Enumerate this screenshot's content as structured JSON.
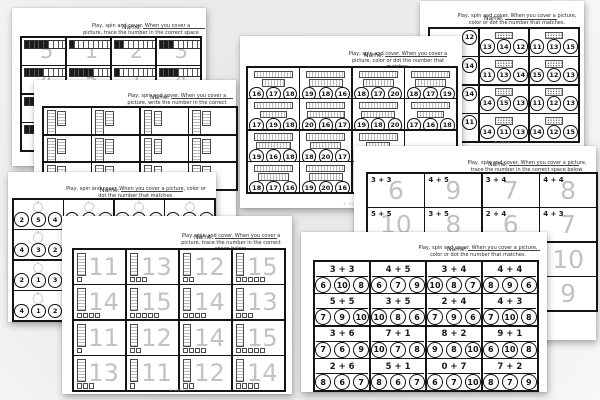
{
  "common": {
    "name_label": "Name:",
    "footer_credit": "© 2018"
  },
  "pages": {
    "trace_1_5": {
      "title": "Spin and cover — trace numbers 1 to 5 with counting frames",
      "instruction": "Play, spin and cover. When you cover a picture, trace the number in the correct space below.",
      "cell_type": "frame_trace",
      "rows": [
        [
          {
            "frame": 5,
            "num": "5"
          },
          {
            "frame": 1,
            "num": "1"
          },
          {
            "frame": 2,
            "num": "2"
          },
          {
            "frame": 3,
            "num": "3"
          }
        ],
        [
          {
            "frame": 4,
            "num": "4"
          },
          {
            "frame": 5,
            "num": "5"
          },
          {
            "frame": 1,
            "num": "1"
          },
          {
            "frame": 4,
            "num": "4"
          }
        ],
        [
          {
            "frame": 2
          },
          {},
          {},
          {}
        ],
        [
          {
            "frame": 5
          },
          {},
          {},
          {}
        ]
      ]
    },
    "write_teens": {
      "title": "Spin and cover — write the number shown by base-ten rods",
      "instruction": "Play, spin and cover. When you cover a picture, write the number in the correct space below.",
      "cell_type": "rods_write",
      "rows": [
        [
          {
            "rods": true
          },
          {
            "rods": true
          },
          {
            "rods": true
          },
          {
            "rods": true
          }
        ],
        [
          {
            "rods": true
          },
          {
            "rods": true
          },
          {
            "rods": true
          },
          {
            "rods": true
          }
        ],
        [
          {
            "rods": true
          },
          {
            "rods": true
          },
          {
            "rods": true
          },
          {
            "rods": true
          }
        ]
      ]
    },
    "color_16_20": {
      "title": "Spin and cover — color or dot the matching number 16 to 20",
      "instruction": "Play, spin and cover. When you cover a picture, color or dot the number that matches.",
      "cell_type": "rod_circles",
      "rows": [
        [
          {
            "circles": [
              16,
              17,
              18
            ]
          },
          {
            "circles": [
              19,
              18,
              16
            ]
          },
          {
            "circles": [
              18,
              17,
              20
            ]
          },
          {
            "circles": [
              18,
              17,
              19
            ]
          }
        ],
        [
          {
            "circles": [
              17,
              19,
              18
            ]
          },
          {
            "circles": [
              20,
              16,
              17
            ]
          },
          {
            "circles": [
              19,
              18,
              20
            ]
          },
          {
            "circles": [
              17,
              16,
              18
            ]
          }
        ],
        [
          {
            "circles": [
              19,
              16,
              18
            ]
          },
          {
            "circles": [
              18,
              20,
              17
            ]
          },
          {
            "circles": [
              16
            ]
          },
          {}
        ],
        [
          {
            "circles": [
              18,
              17,
              16
            ]
          },
          {
            "circles": [
              19,
              20,
              16
            ]
          },
          {
            "circles": [
              18
            ]
          },
          {}
        ]
      ]
    },
    "color_11_15": {
      "title": "Spin and cover — color or dot the matching number 11 to 15",
      "instruction": "Play, spin and cover. When you cover a picture, color or dot the number that matches.",
      "cell_type": "frame_circles",
      "rows": [
        [
          {
            "circles": [
              12
            ],
            "partial": true
          },
          {
            "circles": [
              13,
              14,
              12
            ]
          },
          {
            "circles": [
              11,
              13,
              15
            ]
          }
        ],
        [
          {
            "circles": [
              14
            ],
            "partial": true
          },
          {
            "circles": [
              11,
              13,
              14
            ]
          },
          {
            "circles": [
              15,
              12,
              13
            ]
          }
        ],
        [
          {
            "circles": [
              14
            ],
            "partial": true
          },
          {
            "circles": [
              14,
              15,
              13
            ]
          },
          {
            "circles": [
              11,
              12,
              13
            ]
          }
        ],
        [
          {
            "circles": [
              11
            ],
            "partial": true
          },
          {
            "circles": [
              14,
              11,
              13
            ]
          },
          {
            "circles": [
              14,
              12,
              15
            ]
          }
        ]
      ]
    },
    "color_1_5": {
      "title": "Spin and cover — color or dot the matching number 1 to 5",
      "instruction": "Play, spin and cover. When you cover a picture, color or dot the number that matches.",
      "cell_type": "pic_circles",
      "rows": [
        [
          {
            "circles": [
              2,
              5,
              4
            ]
          },
          {
            "circles": [
              1,
              2,
              3
            ]
          },
          {
            "circles": [
              4,
              3,
              2
            ]
          },
          {
            "circles": [
              3,
              1,
              5
            ]
          }
        ],
        [
          {
            "circles": [
              4,
              3,
              2
            ]
          },
          {},
          {},
          {}
        ],
        [
          {
            "circles": [
              2,
              1,
              3
            ]
          },
          {},
          {},
          {}
        ],
        [
          {
            "circles": [
              4,
              1,
              2
            ]
          },
          {},
          {},
          {}
        ]
      ]
    },
    "trace_11_15": {
      "title": "Spin and cover — trace teen numbers with base-ten blocks",
      "instruction": "Play, spin and cover. When you cover a picture, trace the number in the correct space below.",
      "cell_type": "rod_trace",
      "rows": [
        [
          {
            "num": "11"
          },
          {
            "num": "13"
          },
          {
            "num": "12"
          },
          {
            "num": "15"
          }
        ],
        [
          {
            "num": "14"
          },
          {
            "num": "15"
          },
          {
            "num": "14"
          },
          {
            "num": "13"
          }
        ],
        [
          {
            "num": "11"
          },
          {
            "num": "12"
          },
          {
            "num": "14"
          },
          {
            "num": "15"
          }
        ],
        [
          {
            "num": "13"
          },
          {
            "num": "11"
          },
          {
            "num": "12"
          },
          {
            "num": "14"
          }
        ]
      ]
    },
    "trace_sums": {
      "title": "Spin and cover — trace the sum of the addition fact",
      "instruction": "Play, spin and cover. When you cover a picture, trace the number in the correct space below.",
      "cell_type": "fact_trace",
      "rows": [
        [
          {
            "fact": "3 + 3",
            "num": "6"
          },
          {
            "fact": "4 + 5",
            "num": "9"
          },
          {
            "fact": "3 + 4",
            "num": "7"
          },
          {
            "fact": "4 + 4",
            "num": "8"
          }
        ],
        [
          {
            "fact": "5 + 5",
            "num": "10"
          },
          {
            "fact": "3 + 5",
            "num": "8"
          },
          {
            "fact": "2 + 4",
            "num": "6"
          },
          {
            "fact": "4 + 3",
            "num": "7"
          }
        ],
        [
          {},
          {},
          {},
          {
            "num": "10"
          }
        ],
        [
          {},
          {},
          {},
          {
            "num": "9"
          }
        ]
      ]
    },
    "color_sums": {
      "title": "Spin and cover — color or dot the sum that matches",
      "instruction": "Play, spin and cover. When you cover a picture, color or dot the number that matches.",
      "cell_type": "fact_circles",
      "rows": [
        [
          {
            "fact": "3 + 3",
            "circles": [
              6,
              10,
              8
            ]
          },
          {
            "fact": "4 + 5",
            "circles": [
              6,
              7,
              9
            ]
          },
          {
            "fact": "3 + 4",
            "circles": [
              10,
              8,
              7
            ]
          },
          {
            "fact": "4 + 4",
            "circles": [
              8,
              9,
              6
            ]
          }
        ],
        [
          {
            "fact": "5 + 5",
            "circles": [
              7,
              9,
              10
            ]
          },
          {
            "fact": "3 + 5",
            "circles": [
              10,
              8,
              6
            ]
          },
          {
            "fact": "2 + 4",
            "circles": [
              7,
              9,
              6
            ]
          },
          {
            "fact": "4 + 3",
            "circles": [
              7,
              10,
              8
            ]
          }
        ],
        [
          {
            "fact": "3 + 6",
            "circles": [
              7,
              6,
              9
            ]
          },
          {
            "fact": "7 + 1",
            "circles": [
              10,
              7,
              8
            ]
          },
          {
            "fact": "8 + 2",
            "circles": [
              9,
              8,
              10
            ]
          },
          {
            "fact": "9 + 1",
            "circles": [
              6,
              10,
              8
            ]
          }
        ],
        [
          {
            "fact": "2 + 6",
            "circles": [
              8,
              6,
              7
            ]
          },
          {
            "fact": "5 + 1",
            "circles": [
              8,
              6,
              7
            ]
          },
          {
            "fact": "0 + 7",
            "circles": [
              6,
              7,
              10
            ]
          },
          {
            "fact": "7 + 2",
            "circles": [
              8,
              7,
              9
            ]
          }
        ]
      ]
    }
  }
}
